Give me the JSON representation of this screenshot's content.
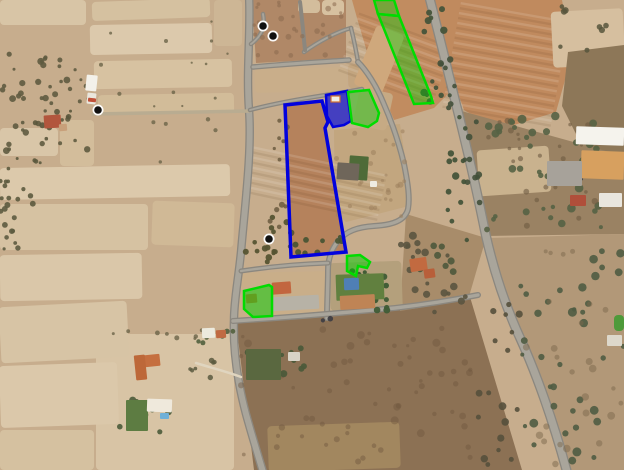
{
  "view": {
    "type": "satellite-aerial-view",
    "width": 624,
    "height": 470,
    "base_color": "#c7ad8d"
  },
  "palette": {
    "field_pale": "#d8c5a6",
    "field_orange": "#c08a5e",
    "scrub_dark": "#8c7154",
    "road_gray": "#8b877f",
    "road_inner": "#a9a59b",
    "overlay_blue": "#0202dd",
    "overlay_blue_fill": "rgba(35,35,205,0.8)",
    "overlay_green": "#00dc00",
    "overlay_green_fill": "rgba(0,205,0,0.42)",
    "marker_black": "#111111",
    "marker_ring": "#ffffff"
  },
  "overlays": [
    {
      "name": "parcel-outline-blue",
      "pts": [
        [
          285,
          105
        ],
        [
          322,
          101
        ],
        [
          328,
          122
        ],
        [
          325,
          128
        ],
        [
          346,
          252
        ],
        [
          291,
          257
        ]
      ],
      "stroke": "#0202dd",
      "sw": 3.5,
      "fill": "none"
    },
    {
      "name": "parcel-blue-filled",
      "pts": [
        [
          326,
          95
        ],
        [
          347,
          91
        ],
        [
          351,
          121
        ],
        [
          344,
          125
        ],
        [
          333,
          127
        ],
        [
          327,
          116
        ]
      ],
      "stroke": "#0202dd",
      "sw": 2.5,
      "fill": "rgba(35,35,205,0.8)"
    },
    {
      "name": "parcel-green-mid",
      "pts": [
        [
          348,
          92
        ],
        [
          369,
          90
        ],
        [
          379,
          113
        ],
        [
          377,
          121
        ],
        [
          368,
          127
        ],
        [
          352,
          123
        ]
      ],
      "stroke": "#00dc00",
      "sw": 2.5,
      "fill": "rgba(0,205,0,0.42)"
    },
    {
      "name": "parcel-green-strip-top",
      "pts": [
        [
          374,
          0
        ],
        [
          394,
          0
        ],
        [
          399,
          16
        ],
        [
          378,
          14
        ]
      ],
      "stroke": "#00dc00",
      "sw": 2.5,
      "fill": "rgba(0,205,0,0.38)"
    },
    {
      "name": "parcel-green-strip-long",
      "pts": [
        [
          378,
          14
        ],
        [
          399,
          16
        ],
        [
          431,
          96
        ],
        [
          433,
          103
        ],
        [
          414,
          104
        ]
      ],
      "stroke": "#00dc00",
      "sw": 2.5,
      "fill": "rgba(0,205,0,0.38)"
    },
    {
      "name": "parcel-green-wedge",
      "pts": [
        [
          347,
          256
        ],
        [
          360,
          255
        ],
        [
          370,
          262
        ],
        [
          367,
          268
        ],
        [
          358,
          266
        ],
        [
          356,
          276
        ],
        [
          347,
          271
        ]
      ],
      "stroke": "#00dc00",
      "sw": 2.5,
      "fill": "rgba(0,205,0,0.5)"
    },
    {
      "name": "parcel-green-left",
      "pts": [
        [
          244,
          291
        ],
        [
          269,
          285
        ],
        [
          272,
          287
        ],
        [
          272,
          316
        ],
        [
          253,
          317
        ],
        [
          244,
          309
        ]
      ],
      "stroke": "#00dc00",
      "sw": 2.5,
      "fill": "rgba(0,205,0,0.5)"
    }
  ],
  "markers": [
    {
      "name": "map-marker",
      "x": 263,
      "y": 26
    },
    {
      "name": "map-marker",
      "x": 273,
      "y": 36
    },
    {
      "name": "map-marker",
      "x": 98,
      "y": 110
    },
    {
      "name": "map-marker",
      "x": 269,
      "y": 239
    }
  ],
  "fields": [
    {
      "n": "field",
      "r": [
        0,
        0,
        86,
        25
      ],
      "f": "#d8c5a6"
    },
    {
      "n": "field",
      "r": [
        92,
        0,
        118,
        19
      ],
      "f": "#d5c1a0",
      "rot": -2
    },
    {
      "n": "field",
      "r": [
        214,
        0,
        28,
        46
      ],
      "f": "#cdb695"
    },
    {
      "n": "field",
      "r": [
        90,
        24,
        122,
        30
      ],
      "f": "#dcc9ac",
      "rot": -1
    },
    {
      "n": "field",
      "r": [
        94,
        60,
        138,
        28
      ],
      "f": "#d7c2a1",
      "rot": -1
    },
    {
      "n": "field",
      "r": [
        0,
        128,
        58,
        28
      ],
      "f": "#d9c6a8"
    },
    {
      "n": "field",
      "r": [
        60,
        120,
        34,
        46
      ],
      "f": "#d3bd9b"
    },
    {
      "n": "field",
      "r": [
        98,
        94,
        136,
        20
      ],
      "f": "#d2bc99",
      "rot": -1
    },
    {
      "n": "field",
      "r": [
        0,
        166,
        230,
        32
      ],
      "f": "#dcc9ab",
      "rot": -1
    },
    {
      "n": "field",
      "r": [
        0,
        204,
        148,
        46
      ],
      "f": "#d6c2a2"
    },
    {
      "n": "field",
      "r": [
        152,
        202,
        82,
        44
      ],
      "f": "#d0b996",
      "rot": 2
    },
    {
      "n": "field",
      "r": [
        0,
        254,
        142,
        46
      ],
      "f": "#dac7a9",
      "rot": -1
    },
    {
      "n": "field",
      "r": [
        96,
        334,
        138,
        136
      ],
      "f": "#d8c4a5"
    },
    {
      "n": "field",
      "r": [
        0,
        304,
        128,
        56
      ],
      "f": "#d7c4a5",
      "rot": -3
    },
    {
      "n": "field",
      "r": [
        0,
        364,
        118,
        62
      ],
      "f": "#dbc8aa",
      "rot": -2
    },
    {
      "n": "field",
      "r": [
        0,
        430,
        94,
        40
      ],
      "f": "#d5c1a0"
    },
    {
      "n": "field-block",
      "p": [
        [
          252,
          0
        ],
        [
          346,
          0
        ],
        [
          346,
          58
        ],
        [
          256,
          63
        ]
      ],
      "f": "#b08867"
    },
    {
      "n": "field",
      "r": [
        298,
        0,
        22,
        13
      ],
      "f": "#d3bd9c"
    },
    {
      "n": "field",
      "r": [
        322,
        0,
        22,
        15
      ],
      "f": "#d7c1a0"
    },
    {
      "n": "field",
      "r": [
        255,
        68,
        92,
        24
      ],
      "f": "#c9ae8a",
      "rot": -1
    },
    {
      "n": "field",
      "r": [
        348,
        64,
        30,
        24
      ],
      "f": "#c3a57f",
      "rot": -2
    },
    {
      "n": "field-orange",
      "p": [
        [
          352,
          0
        ],
        [
          430,
          0
        ],
        [
          452,
          90
        ],
        [
          434,
          108
        ],
        [
          394,
          120
        ],
        [
          370,
          62
        ],
        [
          357,
          18
        ]
      ],
      "f": "#c18c60",
      "streaks": [
        365,
        8,
        62,
        100,
        -70
      ]
    },
    {
      "n": "field",
      "r": [
        364,
        28,
        30,
        64
      ],
      "f": "#cfa87c",
      "rot": 22
    },
    {
      "n": "field-orange",
      "p": [
        [
          432,
          0
        ],
        [
          562,
          0
        ],
        [
          572,
          55
        ],
        [
          556,
          112
        ],
        [
          498,
          130
        ],
        [
          464,
          110
        ],
        [
          444,
          54
        ]
      ],
      "f": "#c08a5e",
      "streaks": [
        452,
        8,
        108,
        110,
        -80
      ]
    },
    {
      "n": "field",
      "r": [
        552,
        10,
        72,
        56
      ],
      "f": "#d6bf9f",
      "rot": -3
    },
    {
      "n": "scrub",
      "p": [
        [
          568,
          52
        ],
        [
          624,
          45
        ],
        [
          624,
          162
        ],
        [
          584,
          150
        ],
        [
          562,
          106
        ]
      ],
      "f": "#8d7758"
    },
    {
      "n": "scrub",
      "p": [
        [
          458,
          110
        ],
        [
          624,
          156
        ],
        [
          624,
          234
        ],
        [
          486,
          236
        ],
        [
          468,
          160
        ]
      ],
      "f": "#9a8263"
    },
    {
      "n": "ruins-patch",
      "r": [
        478,
        148,
        72,
        46
      ],
      "f": "#c9b28e",
      "rot": -4
    },
    {
      "n": "scrub",
      "p": [
        [
          236,
          322
        ],
        [
          400,
          310
        ],
        [
          470,
          297
        ],
        [
          522,
          470
        ],
        [
          254,
          470
        ]
      ],
      "f": "#8c7154"
    },
    {
      "n": "field",
      "r": [
        268,
        424,
        132,
        46
      ],
      "f": "#a2875f",
      "rot": -2
    },
    {
      "n": "scrub",
      "p": [
        [
          490,
          238
        ],
        [
          624,
          234
        ],
        [
          624,
          470
        ],
        [
          562,
          470
        ],
        [
          518,
          330
        ]
      ],
      "f": "#b29878"
    },
    {
      "n": "lawn-patch",
      "r": [
        614,
        315,
        10,
        16
      ],
      "f": "#4e9a3a"
    },
    {
      "n": "scrub",
      "p": [
        [
          406,
          214
        ],
        [
          486,
          238
        ],
        [
          468,
          300
        ],
        [
          400,
          311
        ]
      ],
      "f": "#a88c6a"
    },
    {
      "n": "field-block",
      "p": [
        [
          334,
          130
        ],
        [
          400,
          124
        ],
        [
          406,
          164
        ],
        [
          409,
          206
        ],
        [
          346,
          222
        ],
        [
          335,
          212
        ]
      ],
      "f": "#c2a67f"
    },
    {
      "n": "field",
      "r": [
        356,
        90,
        34,
        38
      ],
      "f": "#c6aa84",
      "rot": 12
    },
    {
      "n": "field",
      "r": [
        238,
        272,
        94,
        44
      ],
      "f": "#c9ae89",
      "rot": -1
    },
    {
      "n": "field",
      "r": [
        330,
        262,
        72,
        48
      ],
      "f": "#b4a07c",
      "rot": -2
    },
    {
      "n": "parcel-interior",
      "p": [
        [
          286,
          106
        ],
        [
          321,
          102
        ],
        [
          327,
          122
        ],
        [
          324,
          128
        ],
        [
          345,
          251
        ],
        [
          292,
          256
        ]
      ],
      "f": "#b5825c",
      "streaks": [
        290,
        112,
        50,
        138,
        -78
      ]
    }
  ],
  "roads": [
    {
      "n": "road-main-left",
      "d": "M249,-4 C251,30 246,70 249,110 C252,150 245,205 241,252 C238,282 234,300 234,320 C233,348 237,380 246,414 C252,436 258,455 263,472",
      "w": 8.5
    },
    {
      "n": "track-west",
      "d": "M93,114 L250,111",
      "w": 3.5,
      "c": "#b9ac91",
      "thin": true
    },
    {
      "n": "road-branch-north",
      "d": "M251,44 C259,38 266,30 263,14",
      "w": 4.5
    },
    {
      "n": "road-sub-top",
      "d": "M253,67 C285,64 320,62 349,60",
      "w": 5.5
    },
    {
      "n": "road-sub-ne",
      "d": "M304,52 C318,42 336,32 351,28",
      "w": 4.5
    },
    {
      "n": "road-sub-v",
      "d": "M351,28 C354,40 356,50 358,62",
      "w": 4.5
    },
    {
      "n": "road-parcels-north",
      "d": "M250,110 C272,104 300,99 326,95 C340,93 352,91 362,89",
      "w": 4.5
    },
    {
      "n": "road-sub-loop",
      "d": "M358,62 C366,70 376,85 383,102 C391,120 399,143 404,164 C408,184 410,198 408,209 C405,221 392,225 374,226 C358,227 346,231 338,241 C331,250 328,259 328,270 C328,286 327,300 327,318",
      "w": 6
    },
    {
      "n": "road-east-track",
      "d": "M241,271 C268,267 298,264 328,263",
      "w": 5
    },
    {
      "n": "road-south",
      "d": "M233,321 C280,318 330,314 395,308 C430,304 458,299 478,295",
      "w": 6
    },
    {
      "n": "highway",
      "d": "M429,-4 C438,30 447,68 457,108 C468,152 478,196 486,236 C496,280 508,312 521,340 C536,373 553,420 567,472",
      "w": 10
    },
    {
      "n": "driveway",
      "d": "M196,363 C212,368 228,372 241,377",
      "w": 2.5,
      "c": "#e0d5bf",
      "thin": true
    },
    {
      "n": "road-block-split",
      "d": "M300,2 C302,18 303,30 305,50",
      "w": 4
    }
  ],
  "tree_clusters": [
    [
      2,
      52,
      88,
      105,
      44,
      1.5,
      3.5,
      "#5f5b40",
      0.9
    ],
    [
      0,
      158,
      42,
      54,
      16,
      1.5,
      3,
      "#5c5a3e",
      0.9
    ],
    [
      88,
      18,
      148,
      78,
      10,
      1,
      2.2,
      "#6b6448",
      0.8
    ],
    [
      150,
      95,
      92,
      70,
      8,
      1,
      2.2,
      "#6b6448",
      0.8
    ],
    [
      242,
      216,
      54,
      50,
      16,
      2,
      3.5,
      "#565433",
      0.95
    ],
    [
      294,
      236,
      50,
      18,
      9,
      2,
      3.2,
      "#4a5434",
      0.95
    ],
    [
      424,
      4,
      20,
      110,
      12,
      2,
      3.8,
      "#46543a",
      0.95
    ],
    [
      446,
      110,
      22,
      130,
      13,
      2,
      3.8,
      "#46543a",
      0.95
    ],
    [
      440,
      10,
      16,
      100,
      8,
      2,
      3.4,
      "#43503a",
      0.9
    ],
    [
      462,
      120,
      18,
      110,
      9,
      2,
      3.4,
      "#43503a",
      0.9
    ],
    [
      486,
      116,
      134,
      116,
      42,
      2,
      4.5,
      "#556244",
      0.9
    ],
    [
      486,
      120,
      130,
      110,
      30,
      1.5,
      3.2,
      "#6e5a41",
      0.6
    ],
    [
      520,
      238,
      104,
      228,
      38,
      2,
      4.5,
      "#4f5c42",
      0.9
    ],
    [
      524,
      244,
      98,
      220,
      26,
      2,
      4,
      "#7c674c",
      0.5
    ],
    [
      400,
      228,
      72,
      84,
      20,
      2,
      4,
      "#5a5440",
      0.9
    ],
    [
      476,
      300,
      48,
      165,
      18,
      2,
      4,
      "#55503c",
      0.9
    ],
    [
      240,
      325,
      232,
      142,
      64,
      1.5,
      4,
      "#6e573f",
      0.45
    ],
    [
      254,
      2,
      90,
      56,
      26,
      1.5,
      3,
      "#8a6a4e",
      0.55
    ],
    [
      336,
      130,
      70,
      90,
      26,
      1.5,
      3,
      "#9c7f5c",
      0.55
    ],
    [
      334,
      270,
      54,
      36,
      10,
      2,
      3.5,
      "#3c5a33",
      0.95
    ],
    [
      368,
      276,
      22,
      38,
      8,
      2,
      3.5,
      "#3f5c36",
      0.95
    ],
    [
      244,
      346,
      42,
      36,
      10,
      2,
      4,
      "#4c5a3a",
      0.95
    ],
    [
      286,
      346,
      20,
      32,
      6,
      2,
      3.5,
      "#4c5a3a",
      0.95
    ],
    [
      118,
      394,
      64,
      42,
      10,
      2,
      4,
      "#52603e",
      0.95
    ],
    [
      192,
      324,
      44,
      20,
      6,
      2,
      3.2,
      "#52603e",
      0.9
    ],
    [
      0,
      208,
      32,
      42,
      10,
      1.5,
      3,
      "#5d5b40",
      0.9
    ],
    [
      28,
      108,
      44,
      32,
      10,
      1.5,
      3,
      "#5a573c",
      0.9
    ],
    [
      556,
      0,
      64,
      52,
      8,
      2,
      3.5,
      "#57553c",
      0.85
    ],
    [
      270,
      118,
      18,
      124,
      12,
      1.5,
      3,
      "#6b5a40",
      0.85
    ],
    [
      548,
      162,
      34,
      22,
      9,
      1.2,
      2,
      "#46464a",
      0.9
    ],
    [
      190,
      358,
      52,
      22,
      7,
      1.5,
      3,
      "#5c5a40",
      0.85
    ],
    [
      96,
      326,
      110,
      16,
      8,
      1.5,
      2.8,
      "#6b6448",
      0.8
    ],
    [
      322,
      318,
      12,
      8,
      2,
      2,
      3,
      "#3c3c42",
      0.9
    ],
    [
      418,
      240,
      40,
      40,
      8,
      2.5,
      4,
      "#4c583c",
      0.9
    ]
  ],
  "buildings": [
    [
      349,
      156,
      19,
      24,
      "#4e6b38",
      4
    ],
    [
      336,
      274,
      48,
      26,
      "#61803f",
      -2
    ],
    [
      126,
      400,
      22,
      31,
      "#5d7c42",
      0
    ],
    [
      246,
      349,
      35,
      31,
      "#5a6840",
      0
    ],
    [
      86,
      75,
      11,
      16,
      "#f3f1ea",
      6
    ],
    [
      87,
      93,
      9,
      11,
      "#eae6dc",
      6
    ],
    [
      88,
      98,
      8,
      4,
      "#c05038",
      6
    ],
    [
      44,
      115,
      17,
      13,
      "#b2563d",
      -4
    ],
    [
      59,
      124,
      8,
      7,
      "#c8a07a",
      -4
    ],
    [
      337,
      163,
      22,
      17,
      "#6f665a",
      4
    ],
    [
      370,
      181,
      7,
      6,
      "#efece2",
      0
    ],
    [
      272,
      282,
      19,
      12,
      "#c2663f",
      -4
    ],
    [
      271,
      296,
      48,
      14,
      "#b7b2a6",
      -3
    ],
    [
      344,
      278,
      15,
      12,
      "#4f7fb5",
      -2
    ],
    [
      340,
      295,
      35,
      14,
      "#bf8455",
      -3
    ],
    [
      246,
      294,
      11,
      9,
      "#c3713f",
      -5
    ],
    [
      202,
      328,
      13,
      10,
      "#eceade",
      -3
    ],
    [
      216,
      330,
      10,
      8,
      "#c06a42",
      -3
    ],
    [
      135,
      355,
      25,
      12,
      "#c56f3f",
      -6
    ],
    [
      135,
      355,
      11,
      25,
      "#bd6839",
      -6
    ],
    [
      147,
      399,
      25,
      13,
      "#efe9dc",
      2
    ],
    [
      160,
      413,
      9,
      6,
      "#6fb0d8",
      0
    ],
    [
      576,
      127,
      48,
      18,
      "#f5f3ed",
      2
    ],
    [
      581,
      151,
      43,
      28,
      "#d7a05f",
      2
    ],
    [
      547,
      161,
      35,
      25,
      "#a7a29a",
      0
    ],
    [
      570,
      195,
      16,
      11,
      "#b04f3a",
      0
    ],
    [
      599,
      193,
      23,
      14,
      "#e9e6de",
      0
    ],
    [
      607,
      335,
      15,
      11,
      "#ddd8cb",
      0
    ],
    [
      410,
      258,
      17,
      13,
      "#c26a40",
      -8
    ],
    [
      424,
      269,
      11,
      9,
      "#b85f3a",
      -8
    ],
    [
      288,
      352,
      12,
      9,
      "#d8d3c6",
      0
    ]
  ],
  "top_buildings": [
    [
      331,
      96,
      9,
      6,
      "#f0ede2",
      "#d07030"
    ]
  ]
}
